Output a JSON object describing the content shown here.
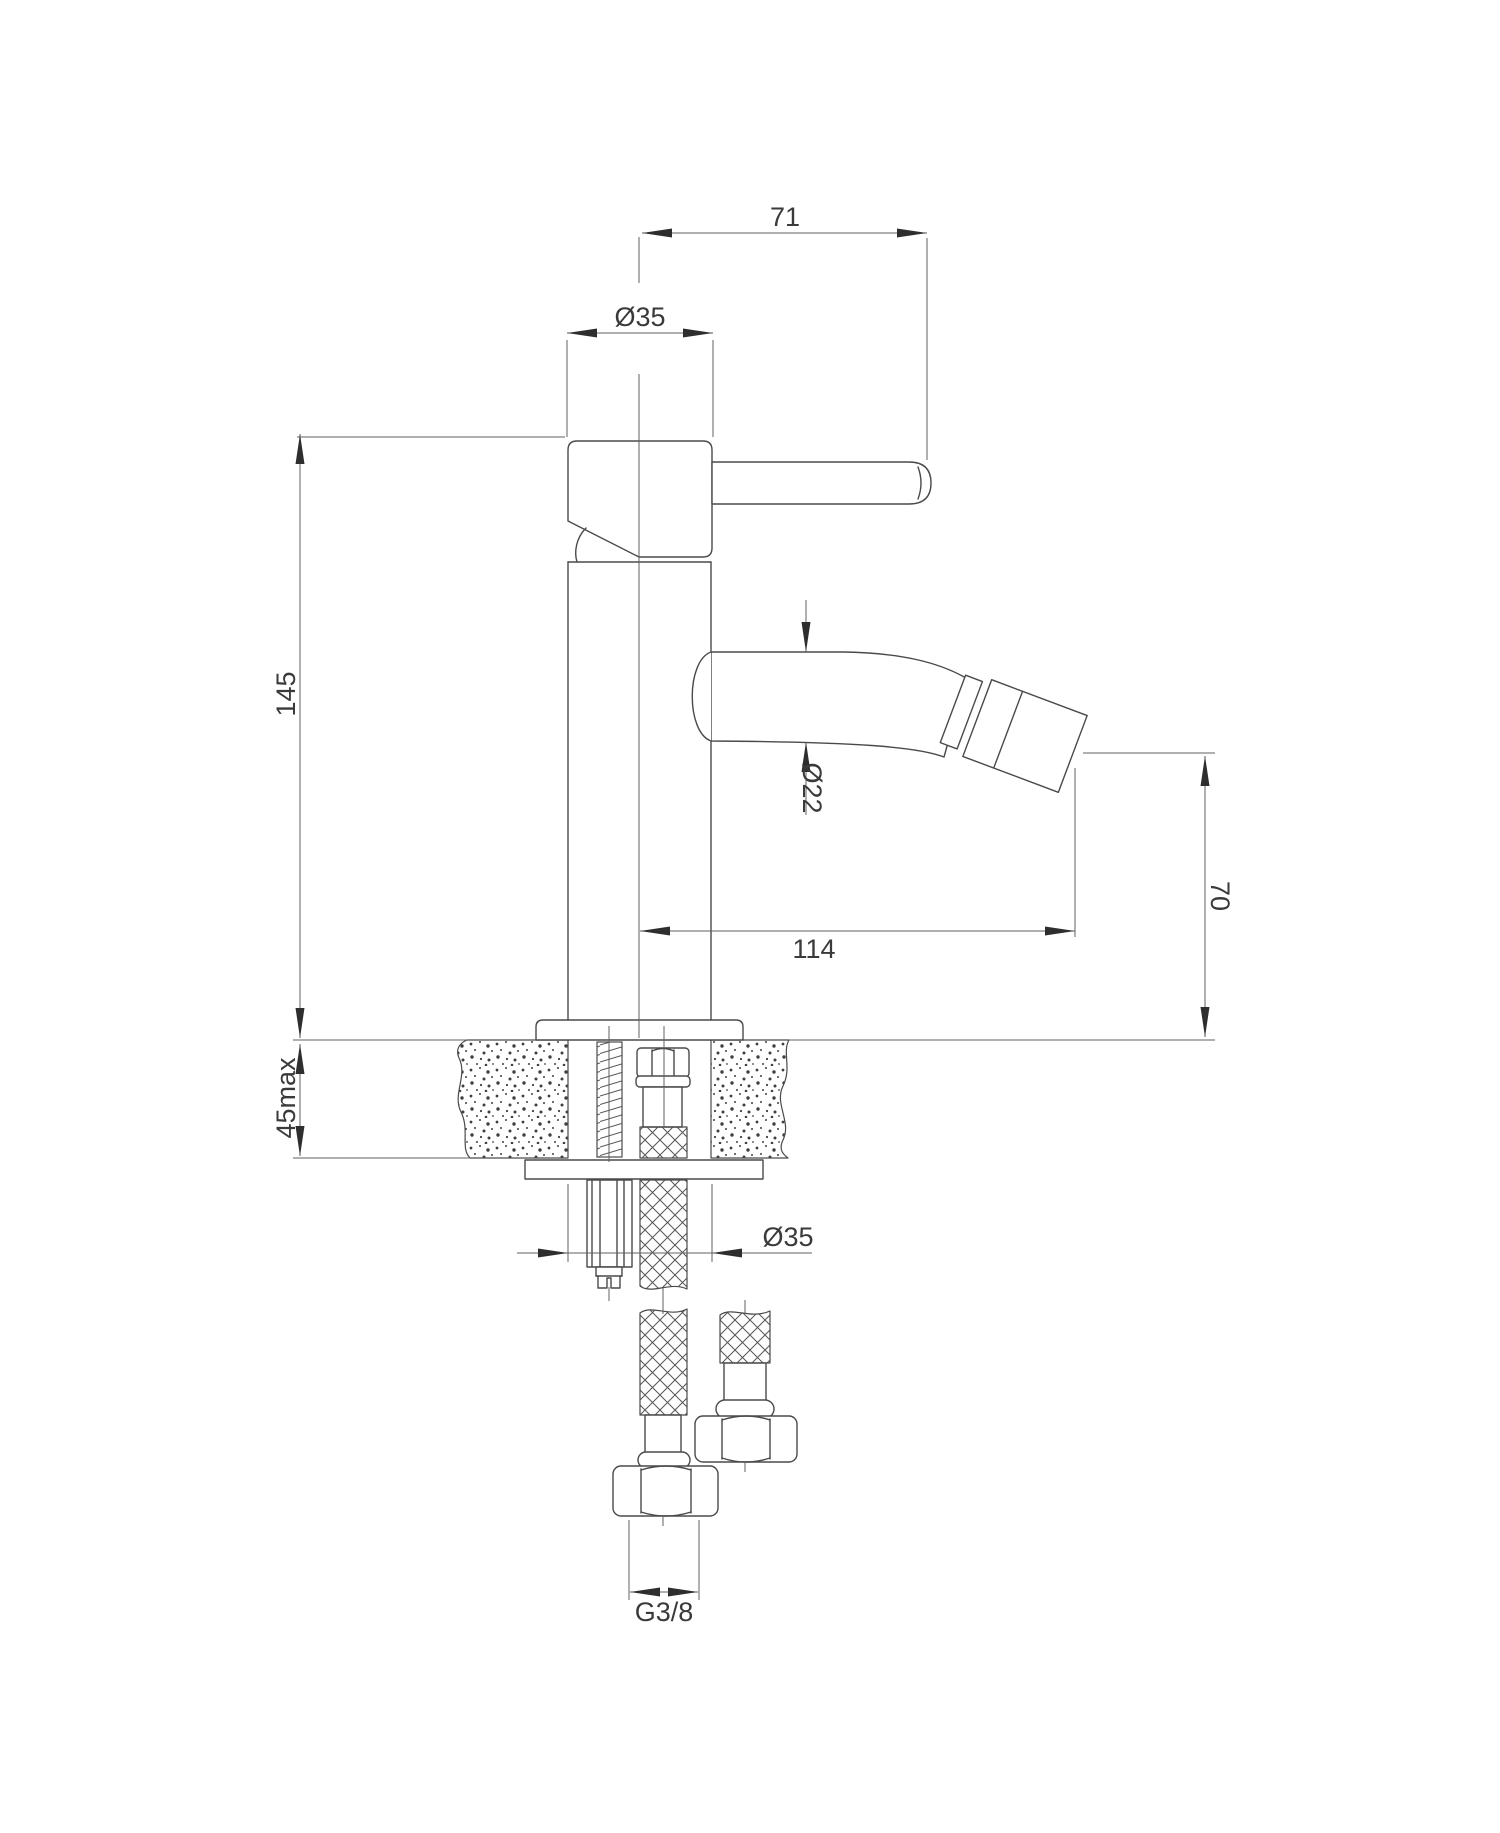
{
  "drawing": {
    "type": "technical-dimension-drawing",
    "subject": "single-lever bidet mixer tap, side view with deck cross-section and supply hoses",
    "colors": {
      "background": "#ffffff",
      "object_line": "#4a4a4a",
      "dimension_line": "#606060",
      "text": "#3a3a3a"
    },
    "dims": {
      "handle_projection": "71",
      "body_diameter_top": "Ø35",
      "body_height": "145",
      "spout_diameter": "Ø22",
      "outlet_height": "70",
      "spout_projection": "114",
      "deck_thickness_max": "45max",
      "body_diameter_bottom": "Ø35",
      "supply_thread": "G3/8"
    }
  }
}
